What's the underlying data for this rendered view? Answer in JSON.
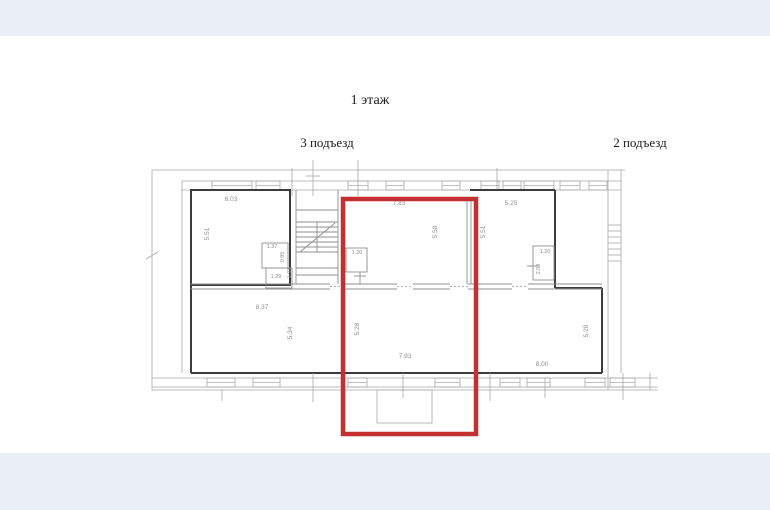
{
  "titles": {
    "floor": "1 этаж",
    "entrance_3": "3 подъезд",
    "entrance_2": "2 подъезд"
  },
  "colors": {
    "highlight": "#c4302f",
    "walls": "#3c3c3c",
    "thin_lines": "#a8a8a8",
    "labels": "#8f8f8f",
    "page_band": "#eaeff7"
  },
  "plan": {
    "dimension_labels": [
      {
        "text": "6.03",
        "x": 231,
        "y": 201,
        "rot": 0
      },
      {
        "text": "5.51",
        "x": 209,
        "y": 234,
        "rot": -90
      },
      {
        "text": "7.83",
        "x": 399,
        "y": 205,
        "rot": 0
      },
      {
        "text": "5.58",
        "x": 437,
        "y": 232,
        "rot": -90
      },
      {
        "text": "5.25",
        "x": 511,
        "y": 205,
        "rot": 0
      },
      {
        "text": "5.51",
        "x": 485,
        "y": 232,
        "rot": -90
      },
      {
        "text": "1.20",
        "x": 357,
        "y": 254,
        "rot": 0,
        "size": 5.5
      },
      {
        "text": "1.20",
        "x": 545,
        "y": 253,
        "rot": 0,
        "size": 5.5
      },
      {
        "text": "2.08",
        "x": 540,
        "y": 269,
        "rot": -90,
        "size": 5.5
      },
      {
        "text": "1.37",
        "x": 272,
        "y": 248,
        "rot": 0,
        "size": 5.5
      },
      {
        "text": "0.95",
        "x": 284,
        "y": 257,
        "rot": -90,
        "size": 5.5
      },
      {
        "text": "1.29",
        "x": 276,
        "y": 278,
        "rot": 0,
        "size": 5.5
      },
      {
        "text": "1.98",
        "x": 291,
        "y": 273,
        "rot": -90,
        "size": 5.5
      },
      {
        "text": "8.37",
        "x": 262,
        "y": 309,
        "rot": 0
      },
      {
        "text": "5.34",
        "x": 292,
        "y": 333,
        "rot": -90
      },
      {
        "text": "5.28",
        "x": 359,
        "y": 329,
        "rot": -90
      },
      {
        "text": "7.93",
        "x": 405,
        "y": 358,
        "rot": 0
      },
      {
        "text": "5.28",
        "x": 588,
        "y": 331,
        "rot": -90
      },
      {
        "text": "8.00",
        "x": 542,
        "y": 366,
        "rot": 0
      }
    ]
  }
}
